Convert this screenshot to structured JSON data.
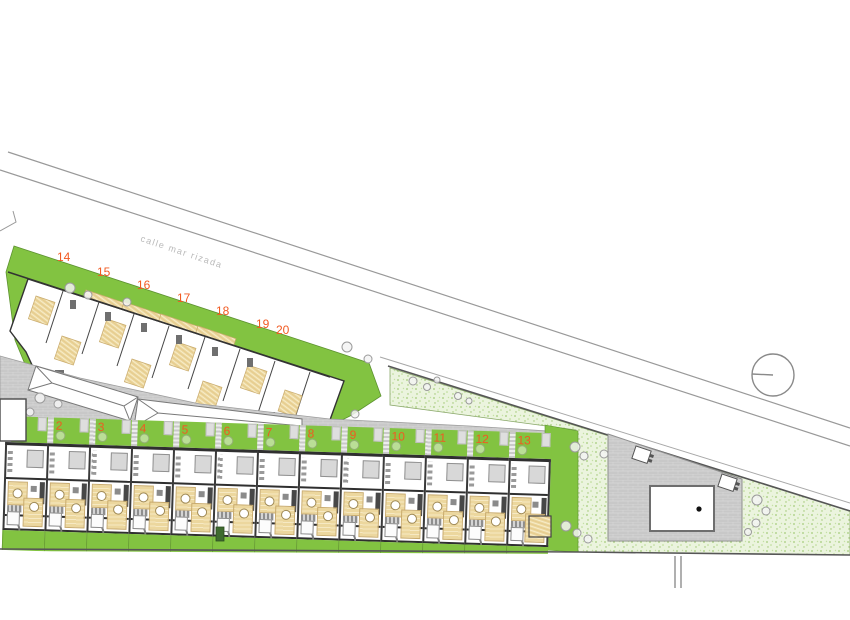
{
  "road": {
    "name": "calle mar rizada"
  },
  "upper_block": {
    "unit_labels": [
      "14",
      "15",
      "16",
      "17",
      "18",
      "19",
      "20"
    ]
  },
  "lower_block": {
    "unit_labels": [
      "",
      "2",
      "3",
      "4",
      "5",
      "6",
      "7",
      "8",
      "9",
      "10",
      "11",
      "12",
      "13"
    ]
  },
  "pool": {
    "label": ""
  },
  "colors": {
    "garden_green": "#82c341",
    "lawn_light_green": "#ebf4de",
    "terrace_tan": "#ecd79e",
    "paving_gray": "#c8c8c8",
    "wall_dark": "#2f2f2f",
    "unit_number_orange": "#f15a22",
    "road_line_gray": "#999999"
  }
}
